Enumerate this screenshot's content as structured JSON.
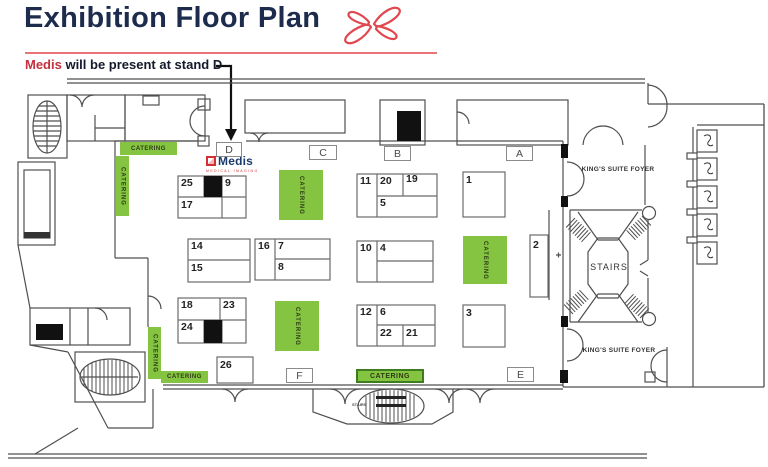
{
  "header": {
    "title": "Exhibition Floor Plan",
    "note_brand": "Medis",
    "note_text": " will be present at stand D"
  },
  "logo": {
    "name": "Medis",
    "tagline": "MEDICAL IMAGING"
  },
  "area_labels": {
    "a": "A",
    "b": "B",
    "c": "C",
    "d": "D",
    "e": "E",
    "f": "F"
  },
  "rooms": {
    "kings_suite_foyer": "KING'S SUITE FOYER",
    "stairs": "STAIRS",
    "catering": "CATERING"
  },
  "stands": {
    "n1": "1",
    "n2": "2",
    "n3": "3",
    "n4": "4",
    "n5": "5",
    "n6": "6",
    "n7": "7",
    "n8": "8",
    "n9": "9",
    "n10": "10",
    "n11": "11",
    "n12": "12",
    "n14": "14",
    "n15": "15",
    "n16": "16",
    "n17": "17",
    "n18": "18",
    "n19": "19",
    "n20": "20",
    "n21": "21",
    "n22": "22",
    "n23": "23",
    "n24": "24",
    "n25": "25",
    "n26": "26"
  },
  "colors": {
    "accent_red": "#d6323c",
    "navy": "#1d2b4d",
    "catering_green": "#84c440",
    "catering_border": "#3e7d1e"
  }
}
